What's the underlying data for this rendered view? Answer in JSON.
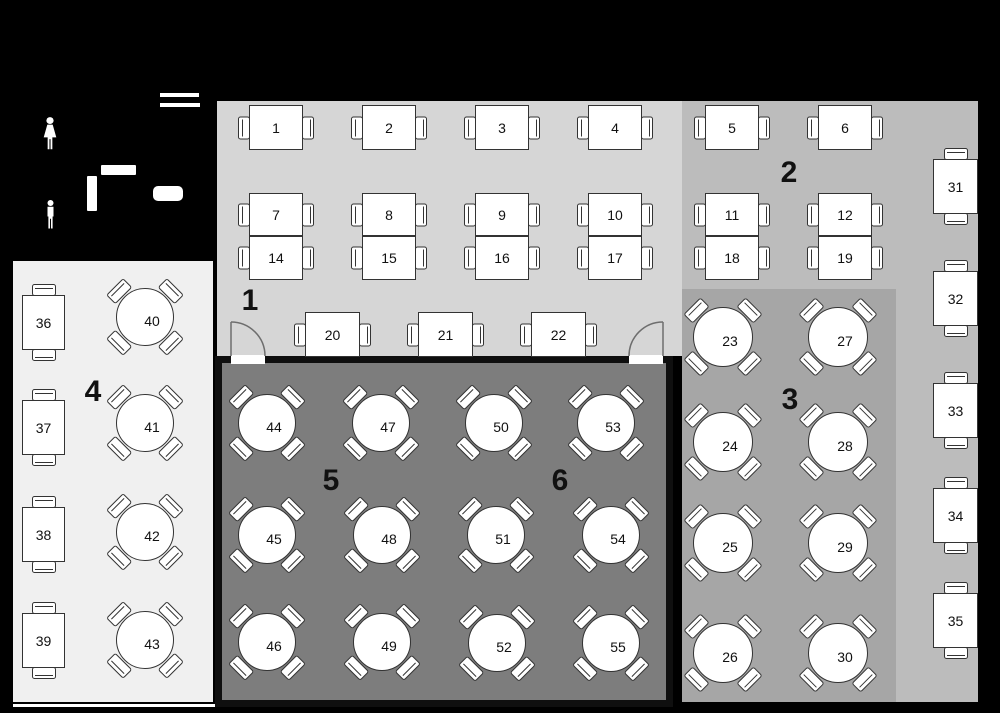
{
  "floorplan": {
    "name": "Restaurant seating floor plan",
    "width": 1000,
    "height": 713
  },
  "colors": {
    "background": "#000000",
    "zone1": "#d6d6d6",
    "zone2": "#bcbcbc",
    "zone3": "#a6a6a6",
    "zone4": "#f0f0f0",
    "room56": "#7d7d7d",
    "wall": "#0f0f0f",
    "table_fill": "#ffffff",
    "table_line": "#333333",
    "door_line": "#6e6e6e",
    "label": "#111111"
  },
  "zones": [
    {
      "id": "1",
      "rect": [
        217,
        101,
        465,
        255
      ],
      "fill": "zone1",
      "wall": false
    },
    {
      "id": "2",
      "rect": [
        682,
        101,
        296,
        601
      ],
      "fill": "zone2",
      "wall": false
    },
    {
      "id": "3",
      "rect": [
        682,
        289,
        214,
        413
      ],
      "fill": "zone3",
      "wall": false
    },
    {
      "id": "4",
      "rect": [
        13,
        261,
        200,
        441
      ],
      "fill": "zone4",
      "wall": false
    },
    {
      "id": "room-5-6",
      "rect": [
        215,
        356,
        458,
        351
      ],
      "fill": "room56",
      "wall": true
    }
  ],
  "zone_labels": [
    {
      "text": "1",
      "x": 250,
      "y": 301
    },
    {
      "text": "2",
      "x": 789,
      "y": 173
    },
    {
      "text": "3",
      "x": 790,
      "y": 400
    },
    {
      "text": "4",
      "x": 93,
      "y": 392
    },
    {
      "text": "5",
      "x": 331,
      "y": 481
    },
    {
      "text": "6",
      "x": 560,
      "y": 481
    }
  ],
  "tables": [
    {
      "number": "1",
      "zone": "1",
      "shape": "rect-h",
      "x": 249,
      "y": 105,
      "w": 54,
      "h": 45
    },
    {
      "number": "2",
      "zone": "1",
      "shape": "rect-h",
      "x": 362,
      "y": 105,
      "w": 54,
      "h": 45
    },
    {
      "number": "3",
      "zone": "1",
      "shape": "rect-h",
      "x": 475,
      "y": 105,
      "w": 54,
      "h": 45
    },
    {
      "number": "4",
      "zone": "1",
      "shape": "rect-h",
      "x": 588,
      "y": 105,
      "w": 54,
      "h": 45
    },
    {
      "number": "5",
      "zone": "2",
      "shape": "rect-h",
      "x": 705,
      "y": 105,
      "w": 54,
      "h": 45
    },
    {
      "number": "6",
      "zone": "2",
      "shape": "rect-h",
      "x": 818,
      "y": 105,
      "w": 54,
      "h": 45
    },
    {
      "number": "7",
      "zone": "1",
      "shape": "rect-h",
      "x": 249,
      "y": 193,
      "w": 54,
      "h": 43
    },
    {
      "number": "8",
      "zone": "1",
      "shape": "rect-h",
      "x": 362,
      "y": 193,
      "w": 54,
      "h": 43
    },
    {
      "number": "9",
      "zone": "1",
      "shape": "rect-h",
      "x": 475,
      "y": 193,
      "w": 54,
      "h": 43
    },
    {
      "number": "10",
      "zone": "1",
      "shape": "rect-h",
      "x": 588,
      "y": 193,
      "w": 54,
      "h": 43
    },
    {
      "number": "11",
      "zone": "2",
      "shape": "rect-h",
      "x": 705,
      "y": 193,
      "w": 54,
      "h": 43
    },
    {
      "number": "12",
      "zone": "2",
      "shape": "rect-h",
      "x": 818,
      "y": 193,
      "w": 54,
      "h": 43
    },
    {
      "number": "14",
      "zone": "1",
      "shape": "rect-h",
      "x": 249,
      "y": 236,
      "w": 54,
      "h": 44
    },
    {
      "number": "15",
      "zone": "1",
      "shape": "rect-h",
      "x": 362,
      "y": 236,
      "w": 54,
      "h": 44
    },
    {
      "number": "16",
      "zone": "1",
      "shape": "rect-h",
      "x": 475,
      "y": 236,
      "w": 54,
      "h": 44
    },
    {
      "number": "17",
      "zone": "1",
      "shape": "rect-h",
      "x": 588,
      "y": 236,
      "w": 54,
      "h": 44
    },
    {
      "number": "18",
      "zone": "2",
      "shape": "rect-h",
      "x": 705,
      "y": 236,
      "w": 54,
      "h": 44
    },
    {
      "number": "19",
      "zone": "2",
      "shape": "rect-h",
      "x": 818,
      "y": 236,
      "w": 54,
      "h": 44
    },
    {
      "number": "20",
      "zone": "1",
      "shape": "rect-h",
      "x": 305,
      "y": 312,
      "w": 55,
      "h": 45
    },
    {
      "number": "21",
      "zone": "1",
      "shape": "rect-h",
      "x": 418,
      "y": 312,
      "w": 55,
      "h": 45
    },
    {
      "number": "22",
      "zone": "1",
      "shape": "rect-h",
      "x": 531,
      "y": 312,
      "w": 55,
      "h": 45
    },
    {
      "number": "23",
      "zone": "3",
      "shape": "round",
      "cx": 723,
      "cy": 337,
      "r": 30
    },
    {
      "number": "24",
      "zone": "3",
      "shape": "round",
      "cx": 723,
      "cy": 442,
      "r": 30
    },
    {
      "number": "25",
      "zone": "3",
      "shape": "round",
      "cx": 723,
      "cy": 543,
      "r": 30
    },
    {
      "number": "26",
      "zone": "3",
      "shape": "round",
      "cx": 723,
      "cy": 653,
      "r": 30
    },
    {
      "number": "27",
      "zone": "3",
      "shape": "round",
      "cx": 838,
      "cy": 337,
      "r": 30
    },
    {
      "number": "28",
      "zone": "3",
      "shape": "round",
      "cx": 838,
      "cy": 442,
      "r": 30
    },
    {
      "number": "29",
      "zone": "3",
      "shape": "round",
      "cx": 838,
      "cy": 543,
      "r": 30
    },
    {
      "number": "30",
      "zone": "3",
      "shape": "round",
      "cx": 838,
      "cy": 653,
      "r": 30
    },
    {
      "number": "31",
      "zone": "2",
      "shape": "rect-v",
      "x": 933,
      "y": 159,
      "w": 45,
      "h": 55
    },
    {
      "number": "32",
      "zone": "2",
      "shape": "rect-v",
      "x": 933,
      "y": 271,
      "w": 45,
      "h": 55
    },
    {
      "number": "33",
      "zone": "2",
      "shape": "rect-v",
      "x": 933,
      "y": 383,
      "w": 45,
      "h": 55
    },
    {
      "number": "34",
      "zone": "2",
      "shape": "rect-v",
      "x": 933,
      "y": 488,
      "w": 45,
      "h": 55
    },
    {
      "number": "35",
      "zone": "2",
      "shape": "rect-v",
      "x": 933,
      "y": 593,
      "w": 45,
      "h": 55
    },
    {
      "number": "36",
      "zone": "4",
      "shape": "rect-v",
      "x": 22,
      "y": 295,
      "w": 43,
      "h": 55
    },
    {
      "number": "37",
      "zone": "4",
      "shape": "rect-v",
      "x": 22,
      "y": 400,
      "w": 43,
      "h": 55
    },
    {
      "number": "38",
      "zone": "4",
      "shape": "rect-v",
      "x": 22,
      "y": 507,
      "w": 43,
      "h": 55
    },
    {
      "number": "39",
      "zone": "4",
      "shape": "rect-v",
      "x": 22,
      "y": 613,
      "w": 43,
      "h": 55
    },
    {
      "number": "40",
      "zone": "4",
      "shape": "round",
      "cx": 145,
      "cy": 317,
      "r": 29
    },
    {
      "number": "41",
      "zone": "4",
      "shape": "round",
      "cx": 145,
      "cy": 423,
      "r": 29
    },
    {
      "number": "42",
      "zone": "4",
      "shape": "round",
      "cx": 145,
      "cy": 532,
      "r": 29
    },
    {
      "number": "43",
      "zone": "4",
      "shape": "round",
      "cx": 145,
      "cy": 640,
      "r": 29
    },
    {
      "number": "44",
      "zone": "5",
      "shape": "round",
      "cx": 267,
      "cy": 423,
      "r": 29
    },
    {
      "number": "45",
      "zone": "5",
      "shape": "round",
      "cx": 267,
      "cy": 535,
      "r": 29
    },
    {
      "number": "46",
      "zone": "5",
      "shape": "round",
      "cx": 267,
      "cy": 642,
      "r": 29
    },
    {
      "number": "47",
      "zone": "5",
      "shape": "round",
      "cx": 381,
      "cy": 423,
      "r": 29
    },
    {
      "number": "48",
      "zone": "5",
      "shape": "round",
      "cx": 382,
      "cy": 535,
      "r": 29
    },
    {
      "number": "49",
      "zone": "5",
      "shape": "round",
      "cx": 382,
      "cy": 642,
      "r": 29
    },
    {
      "number": "50",
      "zone": "6",
      "shape": "round",
      "cx": 494,
      "cy": 423,
      "r": 29
    },
    {
      "number": "51",
      "zone": "6",
      "shape": "round",
      "cx": 496,
      "cy": 535,
      "r": 29
    },
    {
      "number": "52",
      "zone": "6",
      "shape": "round",
      "cx": 497,
      "cy": 643,
      "r": 29
    },
    {
      "number": "53",
      "zone": "6",
      "shape": "round",
      "cx": 606,
      "cy": 423,
      "r": 29
    },
    {
      "number": "54",
      "zone": "6",
      "shape": "round",
      "cx": 611,
      "cy": 535,
      "r": 29
    },
    {
      "number": "55",
      "zone": "6",
      "shape": "round",
      "cx": 611,
      "cy": 643,
      "r": 29
    }
  ],
  "doors": [
    {
      "side": "left",
      "gap": [
        231,
        355,
        34,
        9
      ],
      "leaf": [
        231,
        322,
        231,
        356
      ],
      "arc": "M 231 322 A 34 34 0 0 1 265 356"
    },
    {
      "side": "right",
      "gap": [
        629,
        355,
        34,
        9
      ],
      "leaf": [
        663,
        322,
        663,
        356
      ],
      "arc": "M 663 322 A 34 34 0 0 0 629 356"
    }
  ],
  "entrance_marks": [
    [
      160,
      93,
      39,
      4
    ],
    [
      160,
      103,
      40,
      4
    ]
  ],
  "restroom_icons": [
    {
      "type": "female",
      "box": [
        41,
        117,
        18,
        34
      ]
    },
    {
      "type": "male",
      "box": [
        43,
        200,
        15,
        30
      ]
    }
  ],
  "furniture": [
    {
      "rect": [
        101,
        165,
        35,
        10
      ],
      "r": 1
    },
    {
      "rect": [
        87,
        176,
        10,
        35
      ],
      "r": 1
    },
    {
      "rect": [
        153,
        186,
        30,
        15
      ],
      "r": 5
    }
  ],
  "floor_line": [
    13,
    704,
    202,
    3
  ]
}
